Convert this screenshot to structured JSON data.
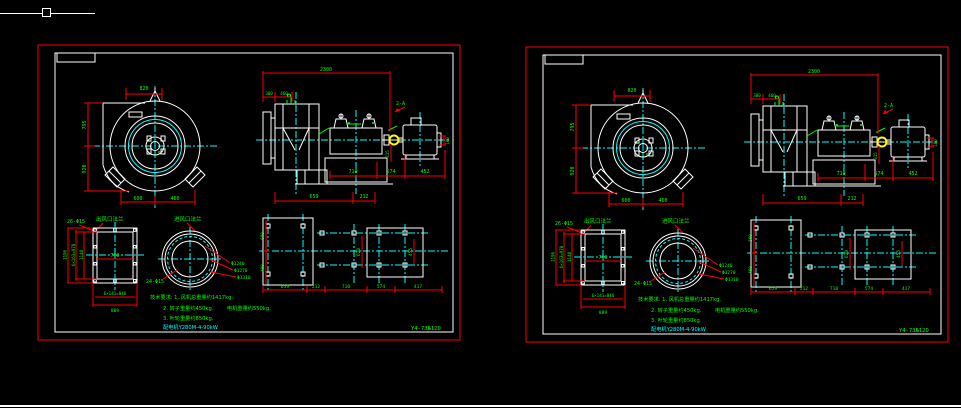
{
  "colors": {
    "background": "#000000",
    "geometry": "#ffffff",
    "dimension_lines": "#ff0000",
    "dimension_text": "#00ff00",
    "centerlines": "#00ffff",
    "coupling": "#ffff00",
    "sheet_border": "#ff0000"
  },
  "drawing": {
    "title_label": "Y4-73№12D",
    "fan_front_view": {
      "dim_top": "820",
      "dim_left_upper": "795",
      "dim_left_lower": "920",
      "dim_bottom_left": "600",
      "dim_bottom_right": "460"
    },
    "side_view": {
      "dim_overall": "2300",
      "dim_inlet_a": "300",
      "dim_inlet_b": "460",
      "section_mark": "2-A",
      "dim_shaft_height": "315",
      "dim_motor_right": "100",
      "dim_bottom_1": "710",
      "dim_bottom_2": "574",
      "dim_bottom_3": "452",
      "dim_base_1": "659",
      "dim_base_2": "212"
    },
    "outlet_flange": {
      "label": "出风口法兰",
      "holes_label": "26-Φ15",
      "dim_height_outer": "1196",
      "dim_height_bolts": "6×163=978",
      "dim_height_inner": "1140",
      "dim_width_inner": "760",
      "dim_width_bolts": "6×141=846",
      "dim_width_outer": "889"
    },
    "inlet_flange": {
      "label": "进风口法兰",
      "holes_label": "24-Φ15",
      "dia_1": "Φ1240",
      "dia_2": "Φ1270",
      "dia_3": "Φ1310"
    },
    "foundation_plan": {
      "dim_bottom_1": "659",
      "dim_bottom_2": "212",
      "dim_bottom_3": "710",
      "dim_bottom_4": "574",
      "dim_bottom_5": "417",
      "dim_left_upper": "600",
      "dim_left_lower": "400",
      "dim_mid_vertical": "620",
      "dim_right_vertical": "455"
    },
    "notes": {
      "line1": "技术要求: 1. 风机总重量约1417kg.",
      "line2a": "2. 转子重量约450kg.",
      "line2b": "电机重量约550kg.",
      "line3": "3. 叶轮重量约850kg.",
      "line4": "配电机Y280M-4-90kW"
    }
  }
}
